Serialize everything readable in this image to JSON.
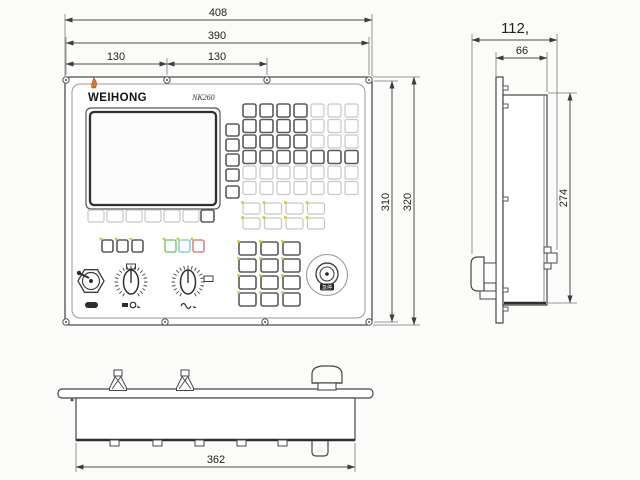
{
  "front_view": {
    "brand": "WEIHONG",
    "model": "NK260",
    "estop_label": "急停",
    "watermark_char1": "维",
    "watermark_char2": "宏",
    "dims": {
      "overall_width": "408",
      "mount_width": "390",
      "hole_pitch_left": "130",
      "hole_pitch_right": "130",
      "mount_height": "310",
      "overall_height": "320"
    }
  },
  "side_view": {
    "dims": {
      "overall_depth": "112,",
      "body_depth": "66",
      "body_height": "274"
    }
  },
  "bottom_view": {
    "dims": {
      "body_width": "362"
    }
  },
  "colors": {
    "line": "#474747",
    "dark_key": "#5a5a5a",
    "light_key": "#c7c7c7",
    "yellow_dot": "#ddc832",
    "green_key": "#86c786",
    "cyan_key": "#8fd0d0",
    "red_key": "#d98585",
    "flame": "#d9782a",
    "label_dark": "#2d2d2d"
  }
}
